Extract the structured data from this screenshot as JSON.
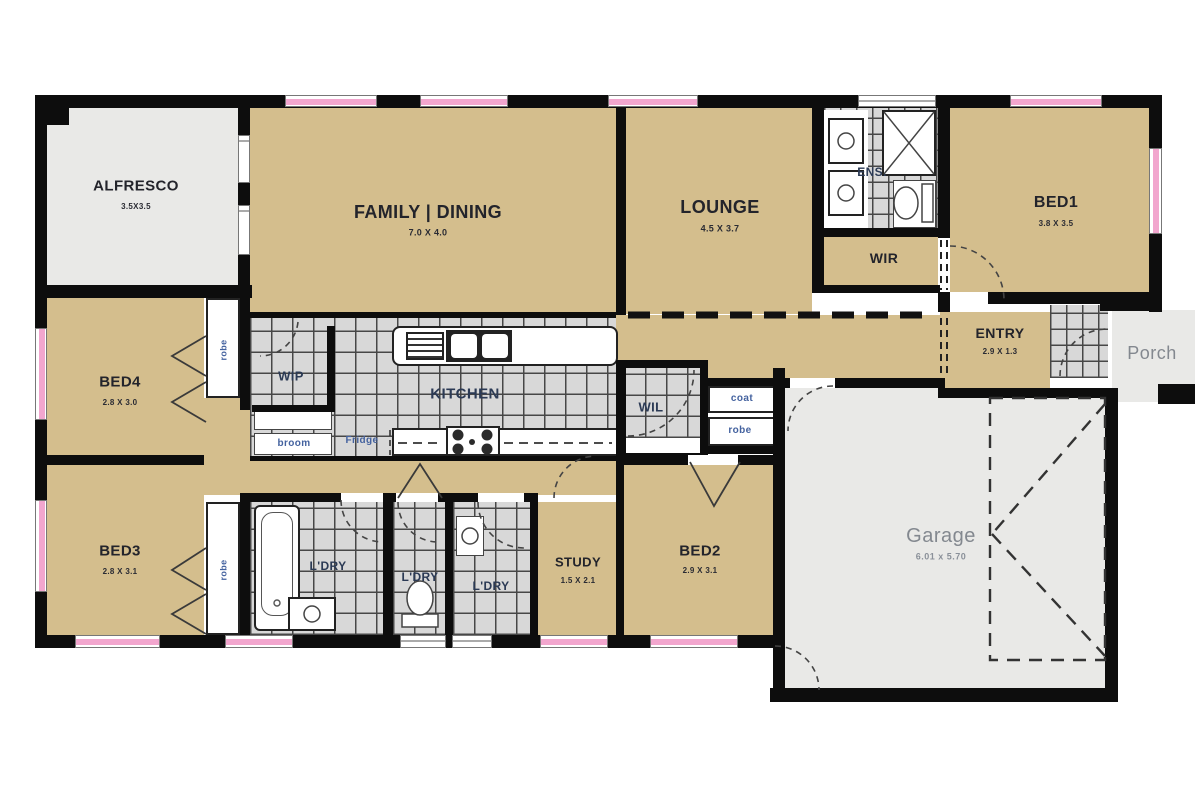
{
  "rooms": {
    "alfresco": {
      "name": "ALFRESCO",
      "size": "3.5X3.5"
    },
    "family_dining": {
      "name": "FAMILY | DINING",
      "size": "7.0 X 4.0"
    },
    "lounge": {
      "name": "LOUNGE",
      "size": "4.5 X 3.7"
    },
    "ens": {
      "name": "ENS."
    },
    "bed1": {
      "name": "BED1",
      "size": "3.8 X 3.5"
    },
    "wir": {
      "name": "WIR"
    },
    "entry": {
      "name": "ENTRY",
      "size": "2.9 X 1.3"
    },
    "porch": {
      "name": "Porch"
    },
    "bed4": {
      "name": "BED4",
      "size": "2.8 X 3.0"
    },
    "wip": {
      "name": "WIP"
    },
    "kitchen": {
      "name": "KITCHEN"
    },
    "wil": {
      "name": "WIL"
    },
    "bed3": {
      "name": "BED3",
      "size": "2.8 X 3.1"
    },
    "ldry1": {
      "name": "L'DRY"
    },
    "ldry2": {
      "name": "L'DRY"
    },
    "ldry3": {
      "name": "L'DRY"
    },
    "study": {
      "name": "STUDY",
      "size": "1.5 X 2.1"
    },
    "bed2": {
      "name": "BED2",
      "size": "2.9 X 3.1"
    },
    "garage": {
      "name": "Garage",
      "size": "6.01 x 5.70"
    }
  },
  "closets": {
    "robe_bed4": "robe",
    "robe_bed3": "robe",
    "coat": "coat",
    "robe_hall": "robe",
    "broom": "broom",
    "fridge": "Fridge"
  },
  "colors": {
    "wall": "#0d0d0d",
    "room_tan": "#d4be8d",
    "tile_gray": "#d8d8d8",
    "outdoor_gray": "#e9e9e7",
    "window_pink": "#f2a6ce",
    "label_dark": "#23242b",
    "label_blue": "#44629f",
    "label_gray": "#83888f"
  }
}
